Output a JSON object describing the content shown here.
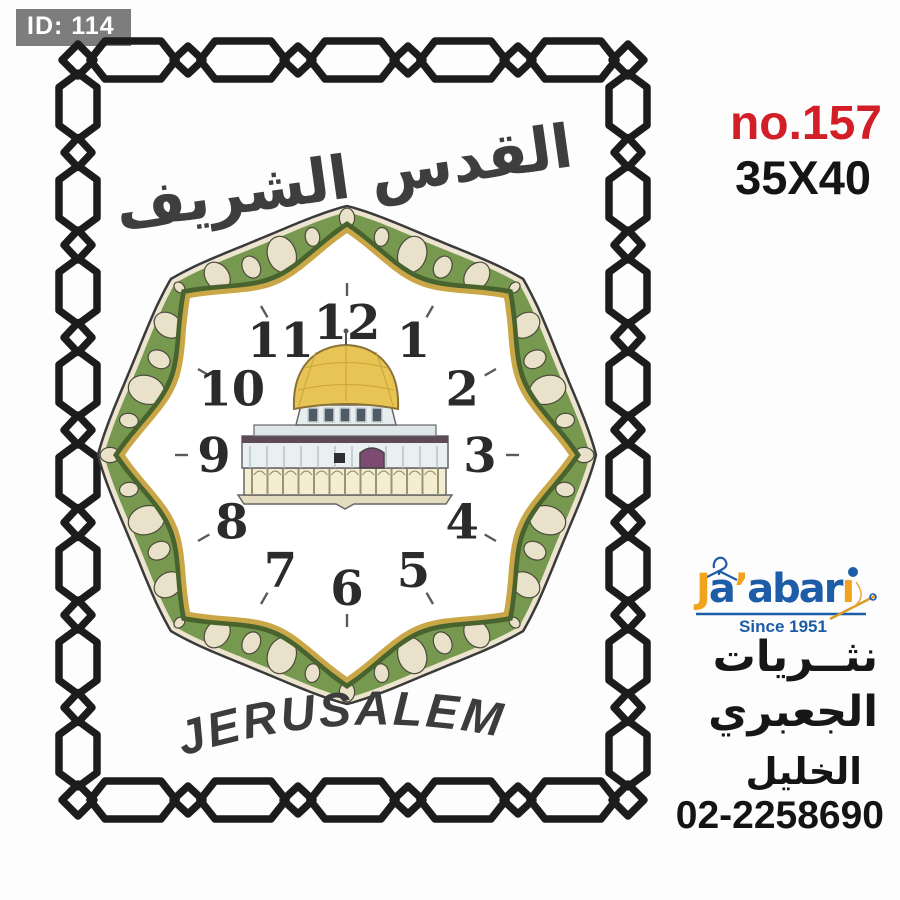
{
  "badge": {
    "label": "ID: 114"
  },
  "product": {
    "number": "no.157",
    "size": "35X40",
    "number_color": "#d21f27"
  },
  "artwork": {
    "title_arabic": "القدس الشريف",
    "city_label": "JERUSALEM",
    "clock_numbers": [
      "12",
      "1",
      "2",
      "3",
      "4",
      "5",
      "6",
      "7",
      "8",
      "9",
      "10",
      "11"
    ],
    "colors": {
      "ring_green": "#76994f",
      "ring_dark_green": "#49632f",
      "gold_band": "#c9a646",
      "petal_cream": "#e9e1ca",
      "rim_cream": "#ece4cf",
      "chain_black": "#1c1c1c",
      "number_black": "#2b2b2b",
      "dome_gold": "#e8c455",
      "door_purple": "#7d4a72"
    }
  },
  "vendor": {
    "logo_text": "Ja’abari",
    "logo_letters": [
      [
        "J",
        "#f0a41e"
      ],
      [
        "a",
        "#1d5da8"
      ],
      [
        "’",
        "#f0a41e"
      ],
      [
        "a",
        "#1d5da8"
      ],
      [
        "b",
        "#1d5da8"
      ],
      [
        "a",
        "#1d5da8"
      ],
      [
        "r",
        "#1d5da8"
      ],
      [
        "ı",
        "#f0a41e"
      ]
    ],
    "since": "Since 1951",
    "name_line1": "نثــريات",
    "name_line2": "الجعبري",
    "city": "الخليل",
    "phone": "02-2258690"
  }
}
